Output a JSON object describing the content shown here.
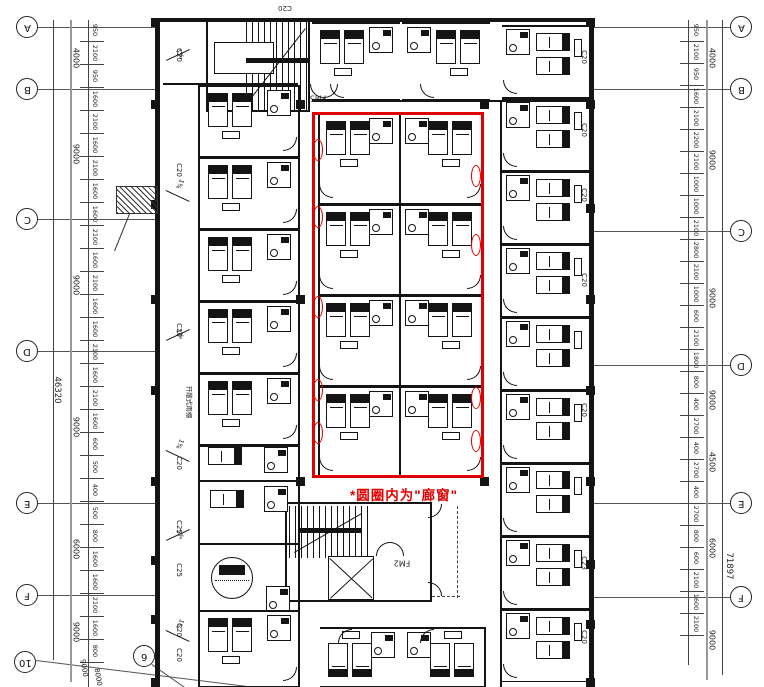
{
  "annotation": {
    "note": "*圆圈内为\"廊窗\"",
    "color": "#e10000"
  },
  "grid": {
    "left": [
      "A",
      "B",
      "C",
      "D",
      "E",
      "F"
    ],
    "right": [
      "A",
      "B",
      "C",
      "D",
      "E",
      "F"
    ],
    "extra": [
      "10",
      "6"
    ]
  },
  "dims": {
    "left_total": "46320",
    "right_total": "71897",
    "left_overall": [
      "4000",
      "9000",
      "9000",
      "9000",
      "6000",
      "9000"
    ],
    "right_overall": [
      "4000",
      "9000",
      "9000",
      "9000",
      "4500",
      "6000",
      "9000"
    ],
    "left_detail": [
      "950",
      "2100",
      "950",
      "1600",
      "2100",
      "1600",
      "2100",
      "1600",
      "1600",
      "2100",
      "1600",
      "2100",
      "1600",
      "1600",
      "2100",
      "1600",
      "2100",
      "1600",
      "600",
      "500",
      "400",
      "500",
      "800",
      "1600",
      "1600",
      "2100",
      "1600",
      "800"
    ],
    "right_detail": [
      "950",
      "2100",
      "950",
      "1600",
      "2100",
      "2200",
      "2100",
      "1000",
      "1000",
      "2100",
      "2800",
      "2100",
      "1000",
      "600",
      "2100",
      "1800",
      "800",
      "400",
      "2700",
      "400",
      "2700",
      "400",
      "2700",
      "800",
      "600",
      "2100",
      "1600",
      "2100"
    ],
    "diagonal": [
      "9000",
      "8000"
    ]
  },
  "windows": {
    "left": [
      "C20",
      "C20",
      "C20",
      "C20",
      "C25",
      "C25",
      "C20",
      "C20"
    ],
    "right": [
      "C20",
      "C20",
      "C20",
      "C20",
      "C20",
      "C23",
      "C20"
    ],
    "top": [
      "C20"
    ]
  },
  "slope_label": "1%",
  "walkway_note": "开敞式雨棚",
  "doors": [
    "FM5",
    "FM2"
  ]
}
